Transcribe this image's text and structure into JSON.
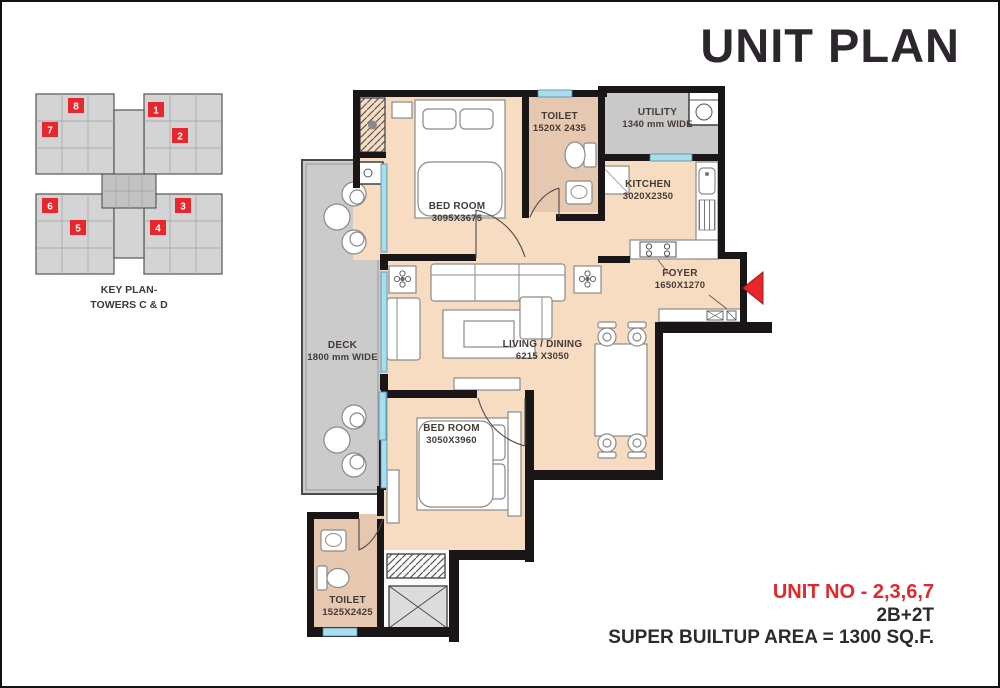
{
  "title": "UNIT PLAN",
  "key_plan": {
    "caption_line1": "KEY PLAN-",
    "caption_line2": "TOWERS C & D",
    "units": [
      "1",
      "2",
      "3",
      "4",
      "5",
      "6",
      "7",
      "8"
    ]
  },
  "rooms": {
    "bedroom1": {
      "name": "BED ROOM",
      "dims": "3095X3675"
    },
    "toilet1": {
      "name": "TOILET",
      "dims": "1520X 2435"
    },
    "utility": {
      "name": "UTILITY",
      "dims": "1340 mm WIDE"
    },
    "kitchen": {
      "name": "KITCHEN",
      "dims": "3020X2350"
    },
    "foyer": {
      "name": "FOYER",
      "dims": "1650X1270"
    },
    "living_dining": {
      "name": "LIVING / DINING",
      "dims": "6215 X3050"
    },
    "deck": {
      "name": "DECK",
      "dims": "1800 mm WIDE"
    },
    "bedroom2": {
      "name": "BED ROOM",
      "dims": "3050X3960"
    },
    "toilet2": {
      "name": "TOILET",
      "dims": "1525X2425"
    }
  },
  "summary": {
    "unit_no": "UNIT NO - 2,3,6,7",
    "configuration": "2B+2T",
    "area": "SUPER BUILTUP AREA = 1300 SQ.F."
  },
  "colors": {
    "floor": "#f8dcc1",
    "toilet_floor": "#e6c7b0",
    "deck_gray": "#cbcbcb",
    "wall": "#1a1516",
    "window_glass": "#a9dcec",
    "accent_red": "#e8252b"
  }
}
